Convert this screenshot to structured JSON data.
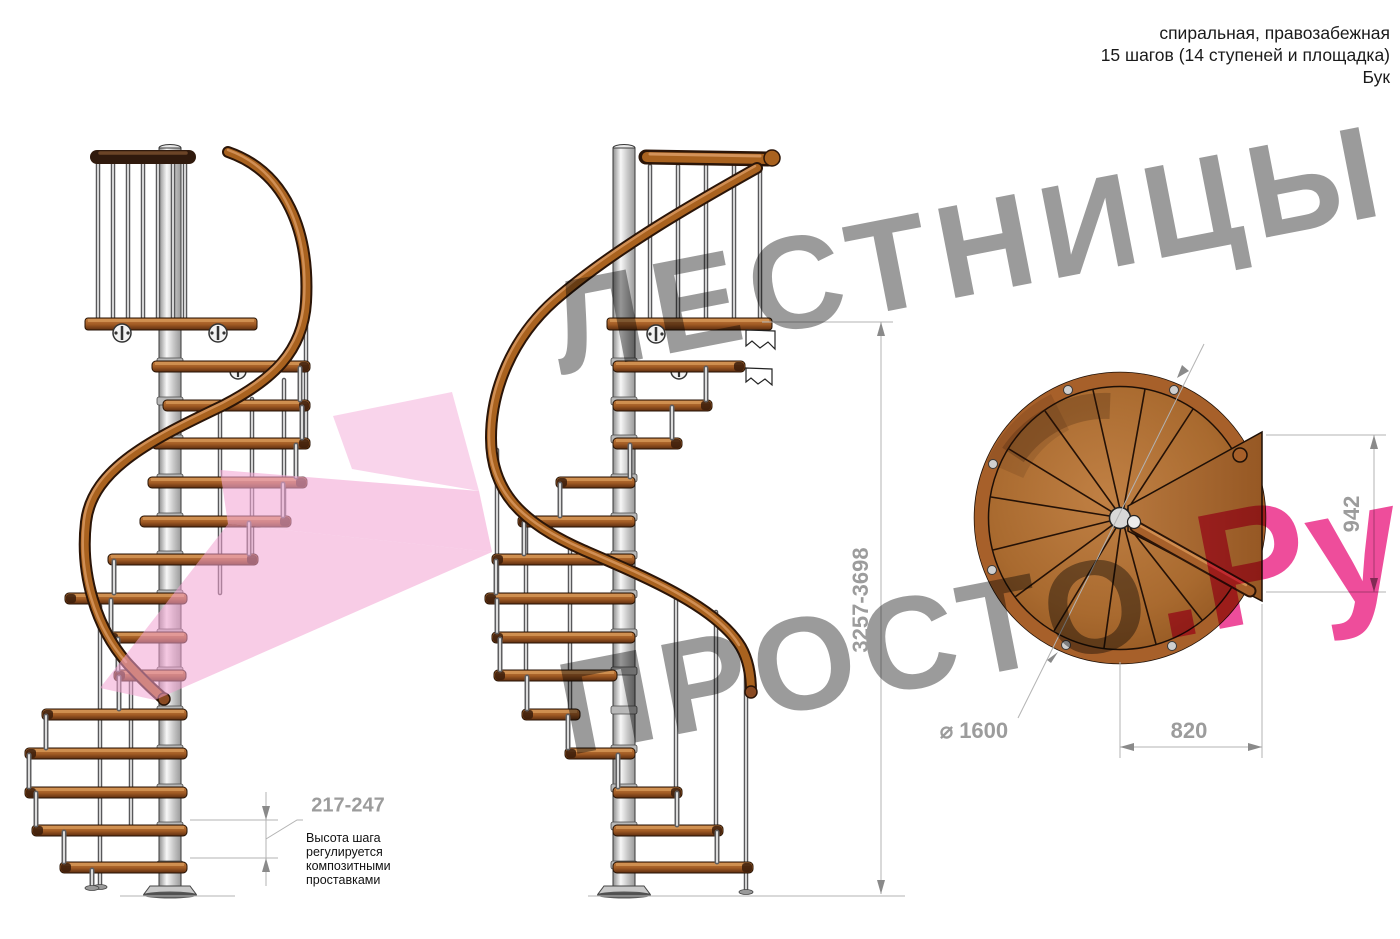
{
  "header": {
    "line1": "спиральная, правозабежная",
    "line2": "15 шагов (14 ступеней и площадка)",
    "line3": "Бук"
  },
  "dimensions": {
    "total_height": "3257-3698",
    "landing_width": "942",
    "landing_depth": "820",
    "diameter": "⌀ 1600",
    "step_height": "217-247"
  },
  "annotation": {
    "step_height_note": "Высота шага\nрегулируется\nкомпозитными\nпроставками"
  },
  "watermark": {
    "line1": "ЛЕСТНИЦЫ",
    "line2_gray": "ПРОСТО",
    "line2_pink": ".Ру"
  },
  "colors": {
    "wood": "#a9642a",
    "handrail": "#a9621f",
    "metal_pole": "#c9c9c9",
    "dimension_gray": "#9c9c9c",
    "accent_pink": "#ee4d9b",
    "watermark_gray": "#9b9b9b"
  }
}
